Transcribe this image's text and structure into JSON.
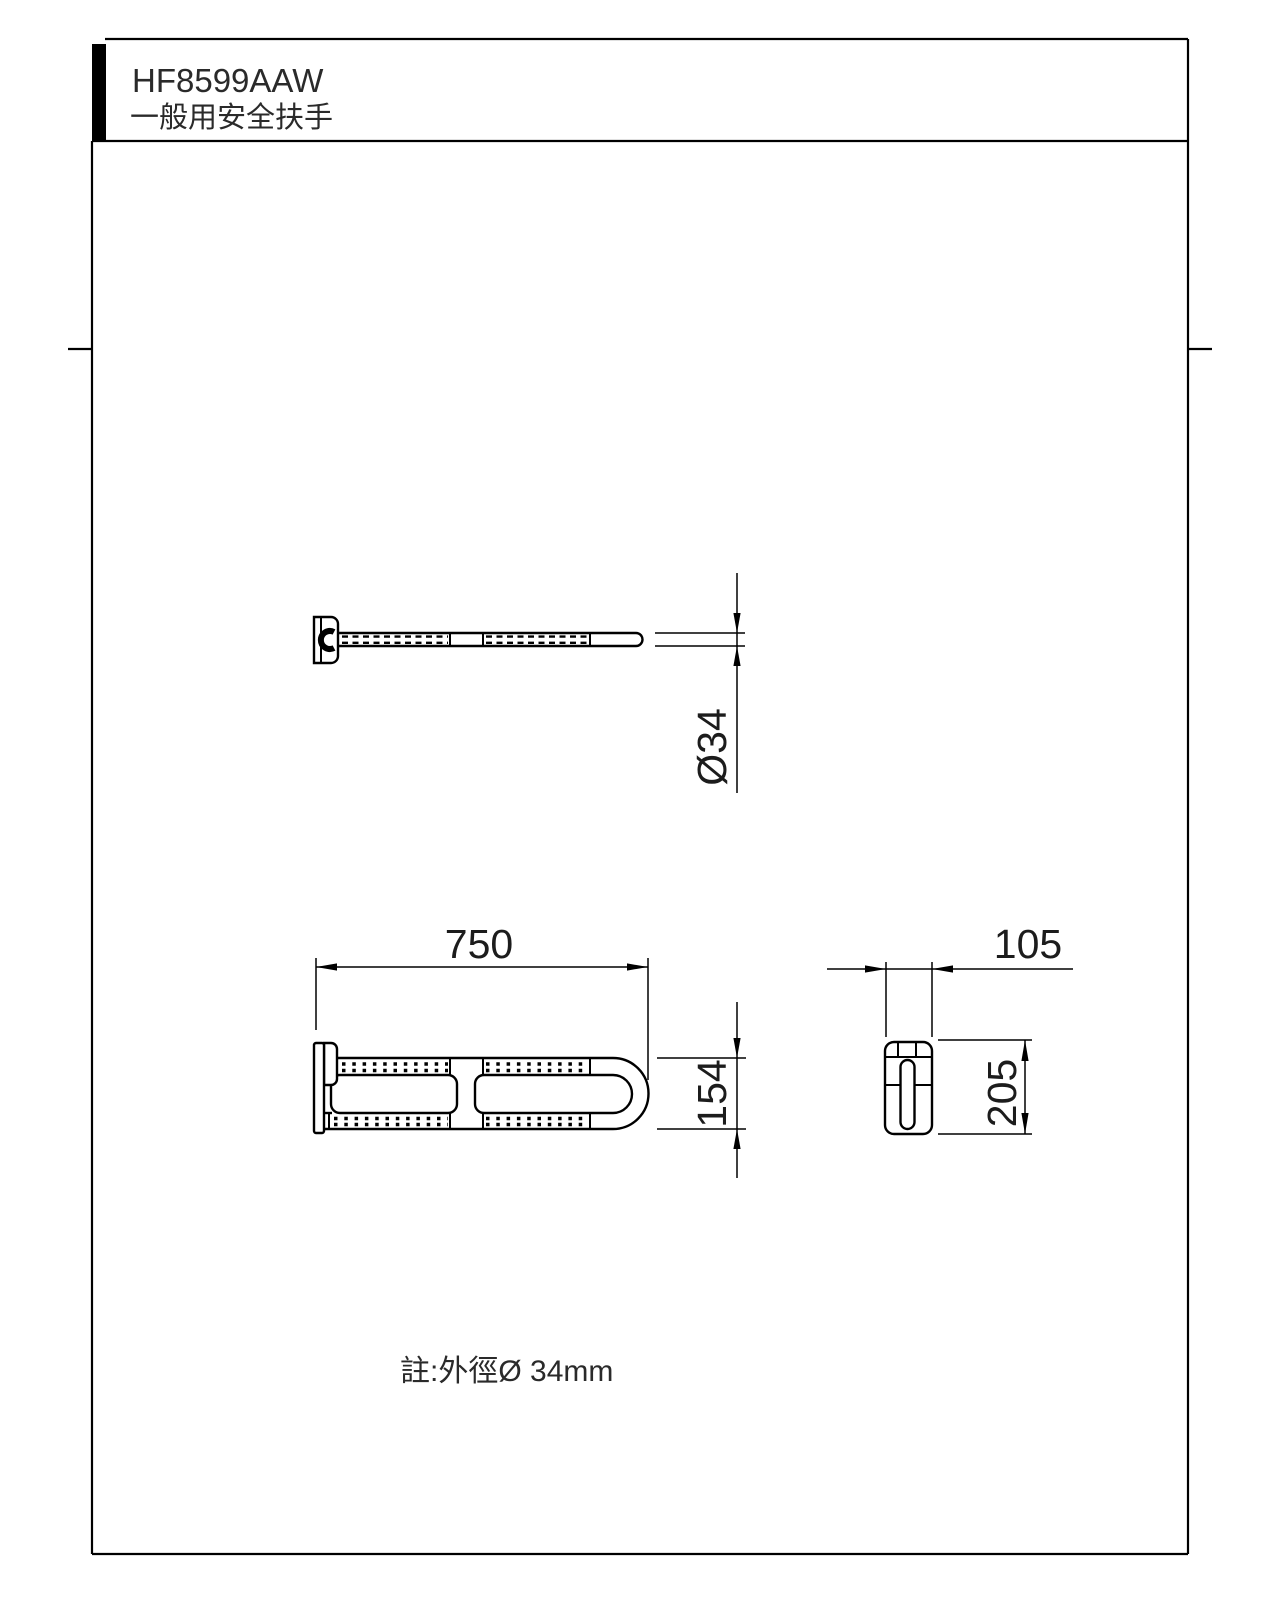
{
  "header": {
    "product_code": "HF8599AAW",
    "product_name": "一般用安全扶手"
  },
  "views": {
    "top": {
      "diameter_label": "Ø34"
    },
    "front": {
      "length_label": "750",
      "height_label": "154"
    },
    "side": {
      "depth_label": "105",
      "plate_height_label": "205"
    }
  },
  "note": {
    "text": "註:外徑Ø 34mm"
  },
  "colors": {
    "line": "#000000",
    "background": "#ffffff",
    "header_bar": "#000000",
    "text": "#2a2a2a"
  }
}
